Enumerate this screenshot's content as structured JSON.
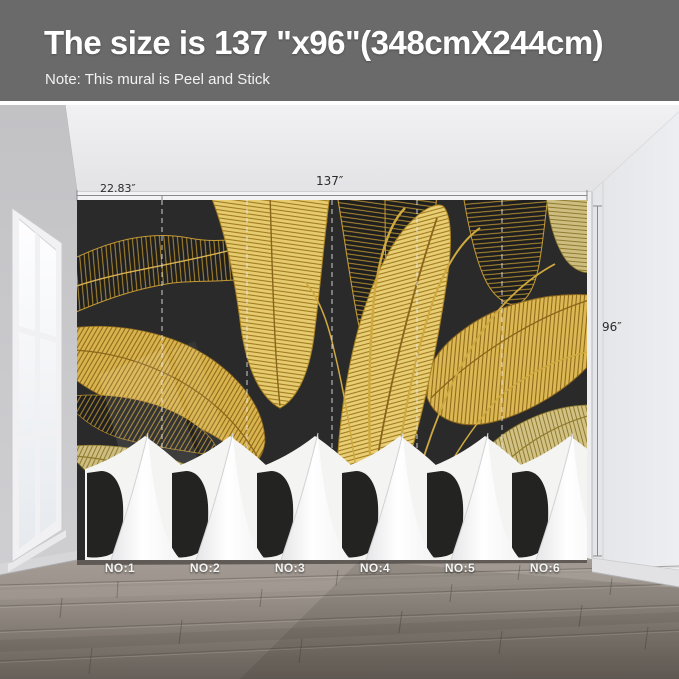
{
  "header": {
    "title": "The size is 137 \"x96\"(348cmX244cm)",
    "note": "Note: This mural is Peel and Stick"
  },
  "dimensions": {
    "total_width": "137″",
    "first_panel_width": "22.83″",
    "height": "96″"
  },
  "mural": {
    "panel_labels": [
      "NO:1",
      "NO:2",
      "NO:3",
      "NO:4",
      "NO:5",
      "NO:6"
    ],
    "panel_count": 6
  },
  "colors": {
    "header_bg": "#6a6a6a",
    "mural_bg": "#2a2a2a",
    "leaf_gold": "#d9b44e",
    "peel_white": "#ffffff"
  }
}
